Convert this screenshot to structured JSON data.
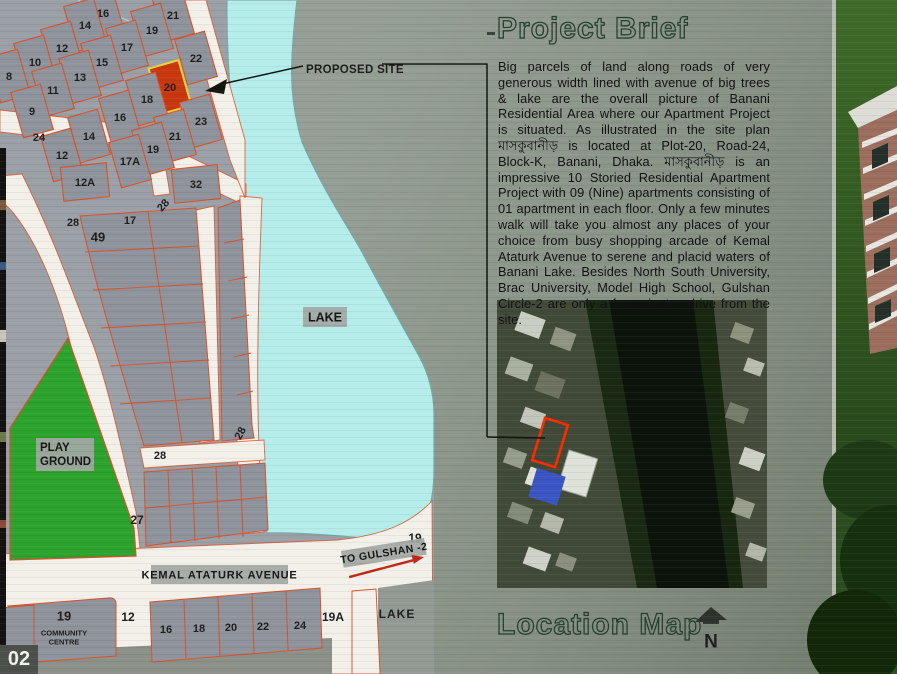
{
  "page": {
    "number": "02"
  },
  "project_brief": {
    "title": "Project Brief",
    "body": "Big parcels of land along roads of very generous width lined with avenue of big trees & lake are the overall picture of Banani Residential Area where our Apartment Project is situated. As illustrated in the site plan মাসকুবানীড় is located at Plot-20, Road-24, Block-K, Banani, Dhaka. মাসকুবানীড় is an impressive 10 Storied Residential Apartment Project with 09 (Nine) apartments consisting of 01 apartment in each floor. Only a few minutes walk will take you almost any places of your choice from busy shopping arcade of Kemal Ataturk Avenue to serene and placid waters of Banani Lake. Besides North South University, Brac University, Model High School, Gulshan Circle-2 are only a few  minutes drive from the site."
  },
  "location_map": {
    "title": "Location Map",
    "north_label": "N"
  },
  "colors": {
    "lake": "#b4edea",
    "road": "#f2f0e8",
    "plot_fill": "#8f949c",
    "plot_border": "#d8522c",
    "site_red": "#c8380f",
    "site_red_border": "#ecd33c",
    "playground": "#2ca32c",
    "label_ink": "#1e1e1e",
    "chip_bg": "#a2a7a3"
  },
  "site_plan": {
    "plots": [
      {
        "t": "16",
        "x": 103,
        "y": 13
      },
      {
        "t": "21",
        "x": 173,
        "y": 15
      },
      {
        "t": "14",
        "x": 85,
        "y": 25
      },
      {
        "t": "19",
        "x": 152,
        "y": 30
      },
      {
        "t": "12",
        "x": 62,
        "y": 48
      },
      {
        "t": "17",
        "x": 127,
        "y": 47
      },
      {
        "t": "10",
        "x": 35,
        "y": 62
      },
      {
        "t": "15",
        "x": 102,
        "y": 62
      },
      {
        "t": "22",
        "x": 196,
        "y": 58
      },
      {
        "t": "8",
        "x": 9,
        "y": 76
      },
      {
        "t": "13",
        "x": 80,
        "y": 77
      },
      {
        "t": "20",
        "x": 170,
        "y": 87,
        "highlight": true
      },
      {
        "t": "11",
        "x": 53,
        "y": 90
      },
      {
        "t": "18",
        "x": 147,
        "y": 99
      },
      {
        "t": "9",
        "x": 32,
        "y": 111
      },
      {
        "t": "16",
        "x": 120,
        "y": 117
      },
      {
        "t": "23",
        "x": 201,
        "y": 121
      },
      {
        "t": "14",
        "x": 89,
        "y": 136
      },
      {
        "t": "21",
        "x": 175,
        "y": 136
      },
      {
        "t": "12",
        "x": 62,
        "y": 155
      },
      {
        "t": "19",
        "x": 153,
        "y": 149
      },
      {
        "t": "17A",
        "x": 130,
        "y": 161
      },
      {
        "t": "12A",
        "x": 85,
        "y": 182,
        "w": 46,
        "h": 34,
        "r": -6
      },
      {
        "t": "32",
        "x": 196,
        "y": 184,
        "w": 46,
        "h": 34,
        "r": -6
      }
    ],
    "labels": [
      {
        "t": "24",
        "x": 39,
        "y": 137
      },
      {
        "t": "49",
        "x": 98,
        "y": 237,
        "s": 13
      },
      {
        "t": "17",
        "x": 130,
        "y": 220
      },
      {
        "t": "28",
        "x": 73,
        "y": 222
      },
      {
        "t": "28",
        "x": 163,
        "y": 205,
        "r": -48
      },
      {
        "t": "28",
        "x": 240,
        "y": 433,
        "r": -62
      },
      {
        "t": "28",
        "x": 160,
        "y": 455
      },
      {
        "t": "27",
        "x": 137,
        "y": 520,
        "s": 12
      },
      {
        "t": "19",
        "x": 415,
        "y": 538,
        "s": 12
      },
      {
        "t": "12",
        "x": 128,
        "y": 617,
        "s": 12
      },
      {
        "t": "19A",
        "x": 333,
        "y": 617,
        "s": 12
      },
      {
        "t": "LAKE",
        "x": 397,
        "y": 614,
        "s": 12,
        "sp": 1
      },
      {
        "t": "16",
        "x": 166,
        "y": 629
      },
      {
        "t": "18",
        "x": 199,
        "y": 628
      },
      {
        "t": "20",
        "x": 231,
        "y": 627
      },
      {
        "t": "22",
        "x": 263,
        "y": 626
      },
      {
        "t": "24",
        "x": 300,
        "y": 625
      },
      {
        "t": "19",
        "x": 64,
        "y": 616,
        "s": 13
      },
      {
        "t": "COMMUNITY",
        "x": 64,
        "y": 633,
        "s": 7.5
      },
      {
        "t": "CENTRE",
        "x": 64,
        "y": 642,
        "s": 7.5
      },
      {
        "t": "PROPOSED SITE",
        "x": 306,
        "y": 69,
        "s": 11.5,
        "anchor": "start",
        "sp": 0.3
      },
      {
        "t": "N",
        "x": 711,
        "y": 641,
        "s": 19
      }
    ],
    "chips": [
      {
        "lines": [
          "LAKE"
        ],
        "x": 303,
        "y": 307,
        "w": 44,
        "h": 20,
        "s": 12.5
      },
      {
        "lines": [
          "PLAY",
          "GROUND"
        ],
        "x": 36,
        "y": 438,
        "w": 58,
        "h": 33,
        "s": 11.5,
        "align": "start"
      },
      {
        "lines": [
          "KEMAL ATATURK AVENUE"
        ],
        "x": 151,
        "y": 565,
        "w": 137,
        "h": 19,
        "s": 11,
        "sp": 0.8
      },
      {
        "lines": [
          "TO GULSHAN -2"
        ],
        "x": 341,
        "y": 551,
        "w": 84,
        "h": 17,
        "s": 10.5,
        "r": -9,
        "sp": 0.5
      }
    ]
  }
}
